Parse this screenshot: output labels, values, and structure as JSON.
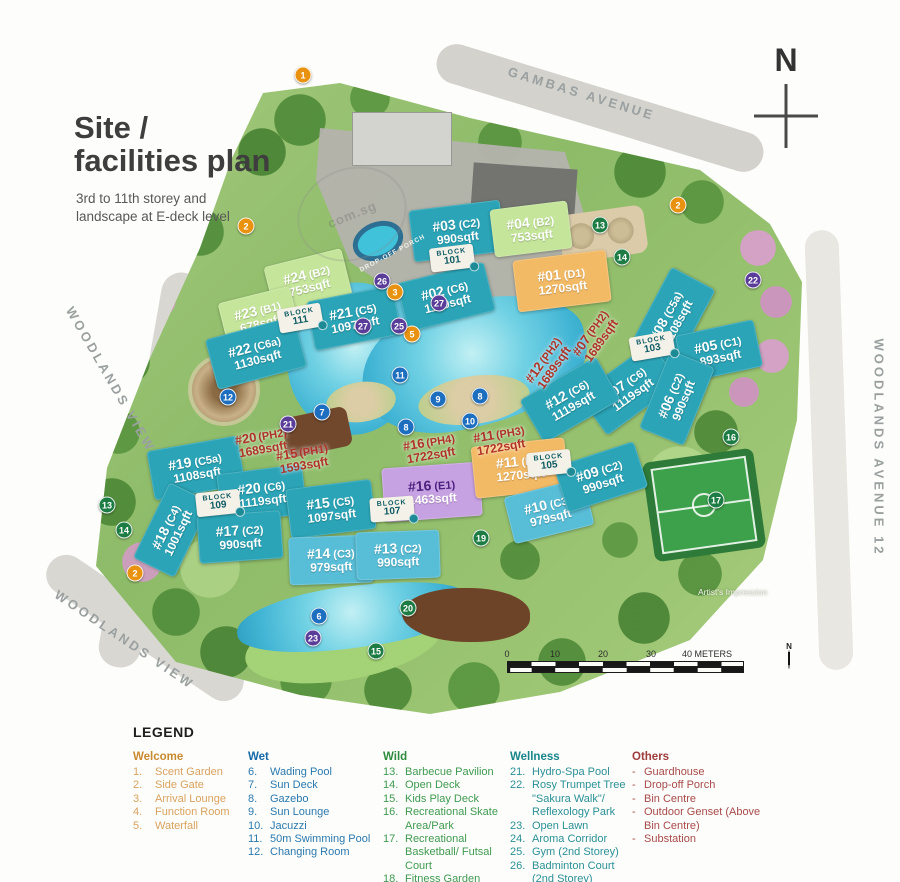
{
  "title": {
    "heading": "Site /\nfacilities plan",
    "subtitle": "3rd to 11th storey and\nlandscape at E-deck level"
  },
  "watermark": "com.sg",
  "roads": {
    "gambas": "GAMBAS AVENUE",
    "woodlands_view_upper": "WOODLANDS VIEW",
    "woodlands_view_lower": "WOODLANDS VIEW",
    "woodlands_ave_12": "WOODLANDS AVENUE 12"
  },
  "compass": {
    "label": "N"
  },
  "artist_impression": "Artist's Impression",
  "scale_bar": {
    "north_label": "N",
    "ticks": [
      {
        "t": "0",
        "x": 0
      },
      {
        "t": "10",
        "x": 48
      },
      {
        "t": "20",
        "x": 96
      },
      {
        "t": "30",
        "x": 144
      },
      {
        "t": "40 METERS",
        "x": 200
      }
    ]
  },
  "map": {
    "labels": {
      "drop_off_porch": "DROP-OFF PORCH"
    },
    "buildings": [
      {
        "unit": "#03",
        "type": "(C2)",
        "area": "990sqft",
        "color": "teal",
        "x": 457,
        "y": 231,
        "w": 92,
        "h": 52,
        "rot": -7
      },
      {
        "unit": "#04",
        "type": "(B2)",
        "area": "753sqft",
        "color": "green",
        "x": 531,
        "y": 229,
        "w": 78,
        "h": 48,
        "rot": -7
      },
      {
        "unit": "#02",
        "type": "(C6)",
        "area": "1119sqft",
        "color": "teal",
        "x": 446,
        "y": 297,
        "w": 90,
        "h": 50,
        "rot": -14
      },
      {
        "unit": "#01",
        "type": "(D1)",
        "area": "1270sqft",
        "color": "orange",
        "x": 562,
        "y": 281,
        "w": 94,
        "h": 52,
        "rot": -7
      },
      {
        "unit": "#24",
        "type": "(B2)",
        "area": "753sqft",
        "color": "green",
        "x": 308,
        "y": 281,
        "w": 80,
        "h": 48,
        "rot": -14
      },
      {
        "unit": "#23",
        "type": "(B1)",
        "area": "678sqft",
        "color": "green",
        "x": 259,
        "y": 317,
        "w": 74,
        "h": 46,
        "rot": -14
      },
      {
        "unit": "#21",
        "type": "(C5)",
        "area": "1097sqft",
        "color": "teal",
        "x": 354,
        "y": 318,
        "w": 88,
        "h": 50,
        "rot": -11
      },
      {
        "unit": "#22",
        "type": "(C6a)",
        "area": "1130sqft",
        "color": "teal",
        "x": 256,
        "y": 353,
        "w": 92,
        "h": 52,
        "rot": -15
      },
      {
        "unit": "#08",
        "type": "(C5a)",
        "area": "1108sqft",
        "color": "teal",
        "x": 672,
        "y": 319,
        "w": 92,
        "h": 50,
        "rot": -62
      },
      {
        "unit": "#05",
        "type": "(C1)",
        "area": "893sqft",
        "color": "teal",
        "x": 719,
        "y": 351,
        "w": 80,
        "h": 48,
        "rot": -12
      },
      {
        "unit": "#07",
        "type": "(C6)",
        "area": "1119sqft",
        "color": "teal",
        "x": 629,
        "y": 389,
        "w": 90,
        "h": 50,
        "rot": -36
      },
      {
        "unit": "#06",
        "type": "(C2)",
        "area": "990sqft",
        "color": "teal",
        "x": 677,
        "y": 398,
        "w": 84,
        "h": 48,
        "rot": -68
      },
      {
        "unit": "#12",
        "type": "(C6)",
        "area": "1119sqft",
        "color": "teal",
        "x": 570,
        "y": 400,
        "w": 88,
        "h": 50,
        "rot": -30
      },
      {
        "unit": "#19",
        "type": "(C5a)",
        "area": "1108sqft",
        "color": "teal",
        "x": 196,
        "y": 468,
        "w": 92,
        "h": 50,
        "rot": -10
      },
      {
        "unit": "#20",
        "type": "(C6)",
        "area": "1119sqft",
        "color": "teal",
        "x": 262,
        "y": 494,
        "w": 86,
        "h": 50,
        "rot": -7
      },
      {
        "unit": "#15",
        "type": "(C5)",
        "area": "1097sqft",
        "color": "teal",
        "x": 331,
        "y": 509,
        "w": 86,
        "h": 50,
        "rot": -7
      },
      {
        "unit": "#18",
        "type": "(C4)",
        "area": "1001sqft",
        "color": "teal",
        "x": 172,
        "y": 530,
        "w": 84,
        "h": 46,
        "rot": -64
      },
      {
        "unit": "#17",
        "type": "(C2)",
        "area": "990sqft",
        "color": "teal",
        "x": 240,
        "y": 537,
        "w": 84,
        "h": 48,
        "rot": -4
      },
      {
        "unit": "#14",
        "type": "(C3)",
        "area": "979sqft",
        "color": "light",
        "x": 331,
        "y": 560,
        "w": 84,
        "h": 48,
        "rot": -2
      },
      {
        "unit": "#13",
        "type": "(C2)",
        "area": "990sqft",
        "color": "light",
        "x": 398,
        "y": 555,
        "w": 84,
        "h": 48,
        "rot": -2
      },
      {
        "unit": "#16",
        "type": "(E1)",
        "area": "1463sqft",
        "color": "purple",
        "x": 432,
        "y": 492,
        "w": 98,
        "h": 54,
        "rot": -4
      },
      {
        "unit": "#11",
        "type": "(D1)",
        "area": "1270sqft",
        "color": "orange",
        "x": 520,
        "y": 468,
        "w": 94,
        "h": 52,
        "rot": -6
      },
      {
        "unit": "#10",
        "type": "(C3)",
        "area": "979sqft",
        "color": "light",
        "x": 549,
        "y": 511,
        "w": 82,
        "h": 48,
        "rot": -14
      },
      {
        "unit": "#09",
        "type": "(C2)",
        "area": "990sqft",
        "color": "teal",
        "x": 601,
        "y": 477,
        "w": 84,
        "h": 48,
        "rot": -18
      }
    ],
    "penthouse_labels": [
      {
        "unit": "#20",
        "type": "(PH2)",
        "area": "1689sqft",
        "x": 262,
        "y": 443,
        "rot": -10
      },
      {
        "unit": "#15",
        "type": "(PH1)",
        "area": "1593sqft",
        "x": 303,
        "y": 459,
        "rot": -10
      },
      {
        "unit": "#16",
        "type": "(PH4)",
        "area": "1722sqft",
        "x": 430,
        "y": 449,
        "rot": -10
      },
      {
        "unit": "#11",
        "type": "(PH3)",
        "area": "1722sqft",
        "x": 500,
        "y": 441,
        "rot": -10
      },
      {
        "unit": "#12",
        "type": "(PH2)",
        "area": "1689sqft",
        "x": 549,
        "y": 364,
        "rot": -55
      },
      {
        "unit": "#07",
        "type": "(PH2)",
        "area": "1689sqft",
        "x": 596,
        "y": 337,
        "rot": -55
      }
    ],
    "blocks": [
      {
        "label": "BLOCK",
        "number": "101",
        "x": 452,
        "y": 258,
        "rot": -7
      },
      {
        "label": "BLOCK",
        "number": "111",
        "x": 300,
        "y": 318,
        "rot": -10
      },
      {
        "label": "BLOCK",
        "number": "103",
        "x": 652,
        "y": 346,
        "rot": -10
      },
      {
        "label": "BLOCK",
        "number": "105",
        "x": 549,
        "y": 463,
        "rot": -6
      },
      {
        "label": "BLOCK",
        "number": "107",
        "x": 392,
        "y": 509,
        "rot": -4
      },
      {
        "label": "BLOCK",
        "number": "109",
        "x": 218,
        "y": 503,
        "rot": -6
      }
    ],
    "markers": [
      {
        "n": "1",
        "kind": "welcome",
        "x": 303,
        "y": 75
      },
      {
        "n": "2",
        "kind": "welcome",
        "x": 246,
        "y": 226
      },
      {
        "n": "2",
        "kind": "welcome",
        "x": 678,
        "y": 205
      },
      {
        "n": "2",
        "kind": "welcome",
        "x": 135,
        "y": 573
      },
      {
        "n": "3",
        "kind": "welcome",
        "x": 395,
        "y": 292
      },
      {
        "n": "5",
        "kind": "welcome",
        "x": 412,
        "y": 334
      },
      {
        "n": "6",
        "kind": "wet",
        "x": 319,
        "y": 616
      },
      {
        "n": "7",
        "kind": "wet",
        "x": 322,
        "y": 412
      },
      {
        "n": "8",
        "kind": "wet",
        "x": 480,
        "y": 396
      },
      {
        "n": "8",
        "kind": "wet",
        "x": 406,
        "y": 427
      },
      {
        "n": "9",
        "kind": "wet",
        "x": 438,
        "y": 399
      },
      {
        "n": "10",
        "kind": "wet",
        "x": 470,
        "y": 421
      },
      {
        "n": "11",
        "kind": "wet",
        "x": 400,
        "y": 375
      },
      {
        "n": "12",
        "kind": "wet",
        "x": 228,
        "y": 397
      },
      {
        "n": "13",
        "kind": "wild",
        "x": 600,
        "y": 225
      },
      {
        "n": "13",
        "kind": "wild",
        "x": 107,
        "y": 505
      },
      {
        "n": "14",
        "kind": "wild",
        "x": 622,
        "y": 257
      },
      {
        "n": "14",
        "kind": "wild",
        "x": 124,
        "y": 530
      },
      {
        "n": "15",
        "kind": "wild",
        "x": 376,
        "y": 651
      },
      {
        "n": "16",
        "kind": "wild",
        "x": 731,
        "y": 437
      },
      {
        "n": "17",
        "kind": "wild",
        "x": 716,
        "y": 500
      },
      {
        "n": "19",
        "kind": "wild",
        "x": 481,
        "y": 538
      },
      {
        "n": "20",
        "kind": "wild",
        "x": 408,
        "y": 608
      },
      {
        "n": "21",
        "kind": "wellness",
        "x": 288,
        "y": 424
      },
      {
        "n": "22",
        "kind": "wellness",
        "x": 753,
        "y": 280
      },
      {
        "n": "23",
        "kind": "wellness",
        "x": 313,
        "y": 638
      },
      {
        "n": "25",
        "kind": "wellness",
        "x": 399,
        "y": 326
      },
      {
        "n": "26",
        "kind": "wellness",
        "x": 382,
        "y": 281
      },
      {
        "n": "27",
        "kind": "wellness",
        "x": 439,
        "y": 303
      },
      {
        "n": "27",
        "kind": "wellness",
        "x": 363,
        "y": 326
      }
    ]
  },
  "legend": {
    "title": "LEGEND",
    "columns": [
      {
        "title": "Welcome",
        "items": [
          {
            "n": "1.",
            "label": "Scent Garden"
          },
          {
            "n": "2.",
            "label": "Side Gate"
          },
          {
            "n": "3.",
            "label": "Arrival Lounge"
          },
          {
            "n": "4.",
            "label": "Function Room"
          },
          {
            "n": "5.",
            "label": "Waterfall"
          }
        ]
      },
      {
        "title": "Wet",
        "items": [
          {
            "n": "6.",
            "label": "Wading Pool"
          },
          {
            "n": "7.",
            "label": "Sun Deck"
          },
          {
            "n": "8.",
            "label": "Gazebo"
          },
          {
            "n": "9.",
            "label": "Sun Lounge"
          },
          {
            "n": "10.",
            "label": "Jacuzzi"
          },
          {
            "n": "11.",
            "label": "50m Swimming Pool"
          },
          {
            "n": "12.",
            "label": "Changing Room"
          }
        ]
      },
      {
        "title": "Wild",
        "items": [
          {
            "n": "13.",
            "label": "Barbecue Pavilion"
          },
          {
            "n": "14.",
            "label": "Open Deck"
          },
          {
            "n": "15.",
            "label": "Kids Play Deck"
          },
          {
            "n": "16.",
            "label": "Recreational Skate Area/Park"
          },
          {
            "n": "17.",
            "label": "Recreational Basketball/ Futsal Court"
          },
          {
            "n": "18.",
            "label": "Fitness Garden"
          },
          {
            "n": "19.",
            "label": "Forest Adventure"
          },
          {
            "n": "20.",
            "label": "Pool Lounge"
          }
        ]
      },
      {
        "title": "Wellness",
        "items": [
          {
            "n": "21.",
            "label": "Hydro-Spa Pool"
          },
          {
            "n": "22.",
            "label": "Rosy Trumpet Tree \"Sakura Walk\"/ Reflexology Park"
          },
          {
            "n": "23.",
            "label": "Open Lawn"
          },
          {
            "n": "24.",
            "label": "Aroma Corridor"
          },
          {
            "n": "25.",
            "label": "Gym (2nd Storey)"
          },
          {
            "n": "26.",
            "label": "Badminton Court (2nd Storey)"
          },
          {
            "n": "27.",
            "label": "Communal Garden (2nd Storey)"
          }
        ]
      },
      {
        "title": "Others",
        "items": [
          {
            "n": "-",
            "label": "Guardhouse"
          },
          {
            "n": "-",
            "label": "Drop-off Porch"
          },
          {
            "n": "-",
            "label": "Bin Centre"
          },
          {
            "n": "-",
            "label": "Outdoor Genset (Above Bin Centre)"
          },
          {
            "n": "-",
            "label": "Substation"
          }
        ]
      }
    ]
  },
  "palette": {
    "building_standard": "#2aa4b6",
    "building_light": "#58bdd6",
    "building_b_type": "#c4e59a",
    "building_d_type": "#f3ba66",
    "building_e_type": "#c7a2e2",
    "penthouse_text": "#b03226",
    "welcome": "#e8920f",
    "wet": "#1e6ec0",
    "wild": "#1d7c44",
    "wellness": "#5a3d99",
    "others": "#9e3b3b"
  }
}
